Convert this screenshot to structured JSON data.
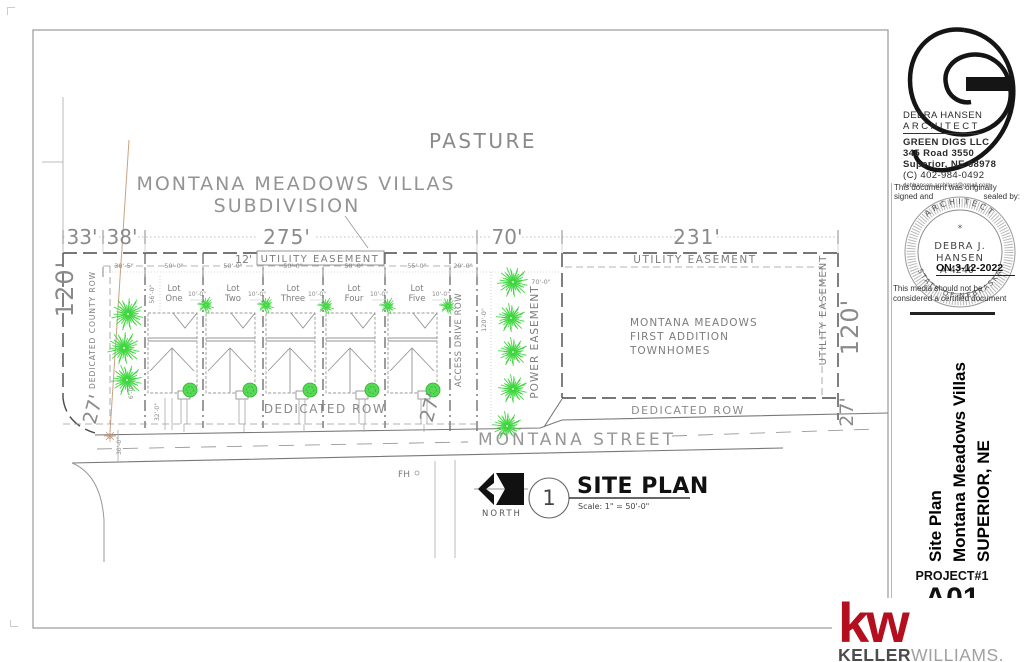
{
  "drawing": {
    "pasture": "PASTURE",
    "title_line1": "MONTANA MEADOWS VILLAS",
    "title_line2": "SUBDIVISION",
    "dims": {
      "left_a": "33'",
      "left_b": "38'",
      "lots": "275'",
      "power": "70'",
      "townhomes": "231'",
      "left_depth": "120'",
      "right_depth": "120'",
      "row_left": "27'",
      "row_mid": "27'",
      "row_right": "27'"
    },
    "easements": {
      "lot_utility_prefix": "12'",
      "lot_utility": "UTILITY EASEMENT",
      "top_right": "UTILITY EASEMENT",
      "right_vertical": "UTILITY EASEMENT",
      "power": "POWER EASEMENT"
    },
    "lot_dims": [
      "38'-5\"",
      "50'-0\"",
      "50'-0\"",
      "50'-0\"",
      "50'-0\"",
      "55'-0\"",
      "20'-0\""
    ],
    "lots": [
      [
        "Lot",
        "One"
      ],
      [
        "Lot",
        "Two"
      ],
      [
        "Lot",
        "Three"
      ],
      [
        "Lot",
        "Four"
      ],
      [
        "Lot",
        "Five"
      ]
    ],
    "setback_dim": "10'-0\"",
    "small_dims": {
      "lot_depth": "56'-0\"",
      "access_depth": "120'-0\"",
      "power_width": "70'-0\"",
      "walk": "6'-0\"",
      "drive": "32'-0\"",
      "street": "30'-0\""
    },
    "rows": {
      "county": "DEDICATED COUNTY ROW",
      "access": "ACCESS DRIVE ROW",
      "dedicated_left": "DEDICATED ROW",
      "dedicated_right": "DEDICATED ROW"
    },
    "townhomes": [
      "MONTANA MEADOWS",
      "FIRST ADDITION",
      "TOWNHOMES"
    ],
    "street": "MONTANA STREET",
    "fire_hydrant": "FH",
    "north_label": "NORTH",
    "view": {
      "number": "1",
      "title": "SITE PLAN",
      "scale": "Scale:  1\" = 50'-0\""
    }
  },
  "title_block": {
    "architect": {
      "name1": "DEBRA HANSEN",
      "name2": "ARCHITECT",
      "firm": "GREEN DIGS LLC",
      "address1": "345 Road 3550",
      "address2": "Superior, NE  68978",
      "phone": "(C) 402-984-0492",
      "email": "debhansen.architect@gmail.com"
    },
    "certification": {
      "line1": "This document was originally",
      "line2_left": "signed and",
      "line2_right": "sealed by:",
      "seal_top": "ARCHITECT",
      "seal_star": "*",
      "seal_name1": "DEBRA J.",
      "seal_name2": "HANSEN",
      "seal_license": "A-4240",
      "seal_date": "ON:3-12-2022",
      "seal_bottom": "STATE OF NEBRASKA",
      "line3": "This media should not be",
      "line4": "considered a certified document"
    },
    "project": {
      "title_line1": "Site Plan",
      "title_line2": "Montana Meadows Villas",
      "title_line3": "SUPERIOR, NE",
      "number": "PROJECT#1",
      "sheet": "A01"
    }
  },
  "watermark": {
    "kw": "kw",
    "keller": "KELLER",
    "williams": "WILLIAMS."
  },
  "colors": {
    "kw_red": "#b30f1e",
    "tree_green": "#3fd63f",
    "boundary_gray": "#4a4a4a",
    "tan": "#c9a282"
  }
}
